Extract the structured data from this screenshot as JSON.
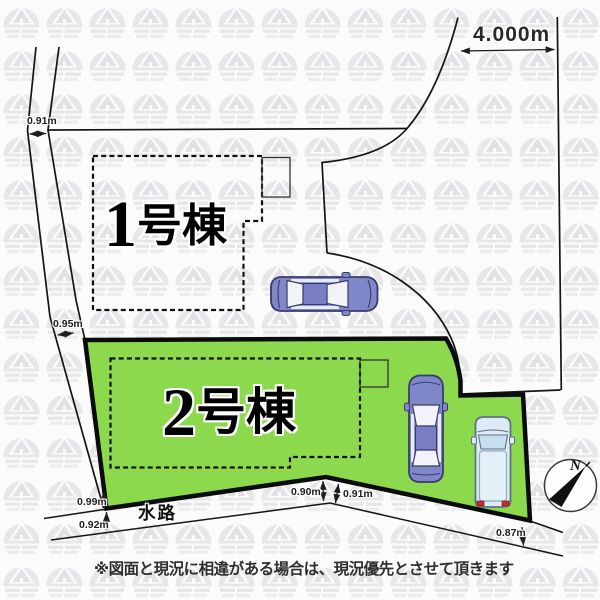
{
  "site_plan": {
    "road_width_label": "4.000m",
    "measure_top_left": "0.91m",
    "measure_mid_left": "0.95m",
    "measure_bottom_1": "0.99m",
    "measure_bottom_2": "0.92m",
    "measure_bottom_3": "0.90m",
    "measure_bottom_4": "0.91m",
    "measure_bottom_5": "0.87m",
    "waterway_label": "水路",
    "lot1": {
      "number": "1",
      "suffix": "号棟"
    },
    "lot2": {
      "number": "2",
      "suffix": "号棟"
    },
    "compass_north_label": "N",
    "disclaimer": "※図面と現況に相違がある場合は、現況優先とさせて頂きます",
    "colors": {
      "lot2_fill": "#8CD94E",
      "line_color": "#1A1A1A",
      "sedan_body": "#8087C9",
      "van_body": "#DCEBF5",
      "taillight": "#CC2A2A",
      "watermark": "#E7E7EA"
    }
  }
}
